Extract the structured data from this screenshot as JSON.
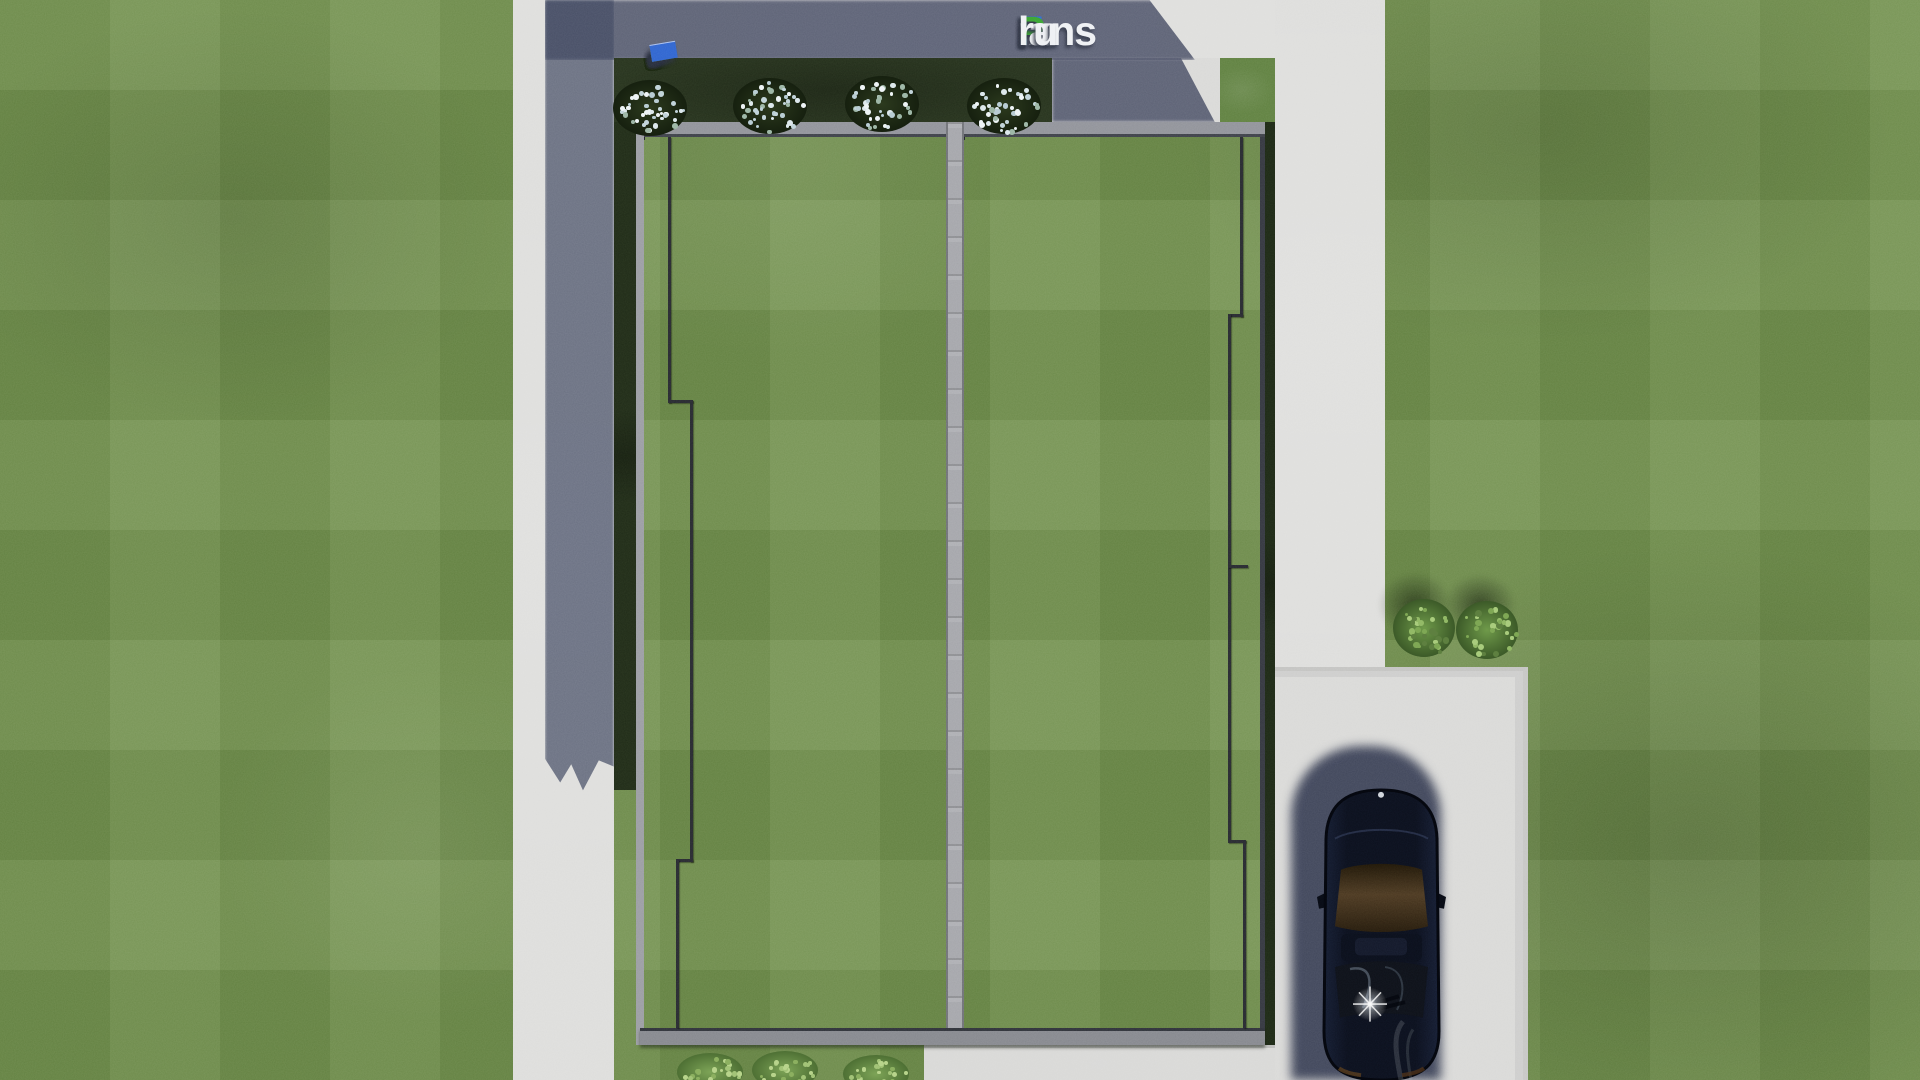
{
  "watermark": {
    "text": "FixPlans.ru",
    "parts": [
      {
        "text": "F",
        "color": "#2e6bd8"
      },
      {
        "text": "ix",
        "color": "#eef0f3"
      },
      {
        "text": "P",
        "color": "#37a330"
      },
      {
        "text": "lans",
        "color": "#eef0f3"
      },
      {
        "text": ".",
        "color": "#2e6bd8"
      },
      {
        "text": "ru",
        "color": "#eef0f3"
      }
    ],
    "shadow_color": "#3a4052"
  },
  "logo_strip": {
    "comment_colors": {
      "white": "#e9ebee",
      "blue": "#2e63cf",
      "green": "#39a431"
    },
    "blocks": [
      {
        "w": 15,
        "h": 9,
        "color": "#e9ebee"
      },
      {
        "w": 8,
        "h": 9,
        "color": "#e9ebee"
      },
      {
        "w": 9,
        "h": 9,
        "color": "#e9ebee"
      },
      {
        "w": 10,
        "h": 10,
        "color": "#2e63cf"
      },
      {
        "w": 17,
        "h": 10,
        "color": "#e9ebee"
      },
      {
        "w": 11,
        "h": 9,
        "color": "#e9ebee"
      },
      {
        "w": 12,
        "h": 10,
        "color": "#e9ebee"
      },
      {
        "w": 16,
        "h": 10,
        "color": "#e9ebee"
      },
      {
        "w": 7,
        "h": 9,
        "color": "#e9ebee"
      },
      {
        "w": 22,
        "h": 11,
        "color": "#39a431"
      },
      {
        "w": 10,
        "h": 10,
        "color": "#e9ebee"
      },
      {
        "w": 8,
        "h": 10,
        "color": "#e9ebee"
      },
      {
        "w": 9,
        "h": 11,
        "color": "#39a431"
      },
      {
        "w": 26,
        "h": 17,
        "color": "#2e63cf"
      }
    ]
  },
  "scene": {
    "colors": {
      "grass": "#6d8c48",
      "grass_shaded_bed": "#26321d",
      "concrete_lit": "#dddddb",
      "concrete_shadow": "#5d6478",
      "driveway": "#d9d9d7",
      "roof_fascia": "#909299",
      "roof_ridge": "#a4a5aa",
      "roof_eaves": "#85878d",
      "roof_cable": "#26282e",
      "car_body": "#0b0f1b",
      "car_glass_brown": "#46331c",
      "car_shadow": "#242c44",
      "bush_flower": "#dde8ec",
      "bush_green": "#6f9a4a",
      "bush_light_green": "#8cab62"
    },
    "roof": {
      "seed": 12,
      "rows": 76,
      "left_cols": 17,
      "right_cols": 17,
      "tile_hue": 225,
      "tile_sat": 8,
      "lightness_choices": [
        26,
        32,
        38,
        44,
        50,
        57,
        64,
        70
      ]
    },
    "bushes": {
      "flower_top": [
        {
          "x": 650,
          "y": 108
        },
        {
          "x": 770,
          "y": 106
        },
        {
          "x": 882,
          "y": 104
        },
        {
          "x": 1004,
          "y": 106
        }
      ],
      "green_right": [
        {
          "x": 1424,
          "y": 628
        },
        {
          "x": 1487,
          "y": 630
        }
      ],
      "green_bottom": [
        {
          "x": 710,
          "y": 1072
        },
        {
          "x": 785,
          "y": 1070
        },
        {
          "x": 876,
          "y": 1074
        }
      ]
    }
  }
}
